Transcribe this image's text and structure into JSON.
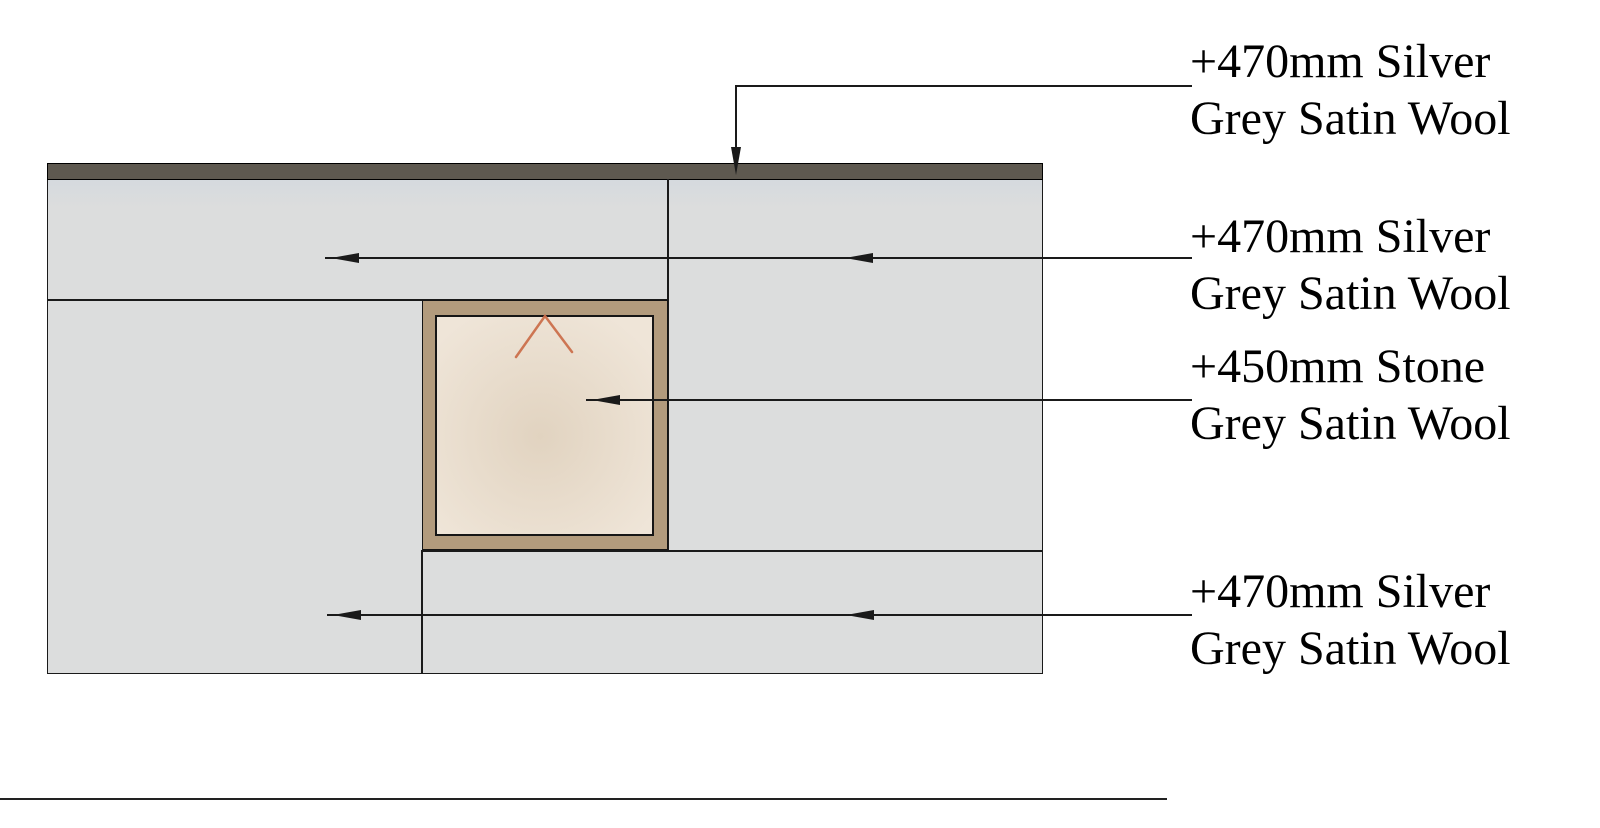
{
  "drawing_title": "Wall insulation detail",
  "colors": {
    "background": "#ffffff",
    "line": "#1a1a1a",
    "capping_strip": "#5e5950",
    "wool_panel": "#dcdddd",
    "wool_panel_tint": "#d5dade",
    "stone_frame": "#b29b7d",
    "stone_fill_light": "#efe5d8",
    "stone_fill_dark": "#e1d3c0",
    "chevron_accent": "#cb6f4b",
    "text": "#000000"
  },
  "annotations": [
    {
      "id": "top-capping",
      "line1": "+470mm Silver",
      "line2": "Grey Satin Wool"
    },
    {
      "id": "upper-wool",
      "line1": "+470mm Silver",
      "line2": "Grey Satin Wool"
    },
    {
      "id": "stone-panel",
      "line1": "+450mm Stone",
      "line2": "Grey Satin Wool"
    },
    {
      "id": "lower-wool",
      "line1": "+470mm Silver",
      "line2": "Grey Satin Wool"
    }
  ]
}
